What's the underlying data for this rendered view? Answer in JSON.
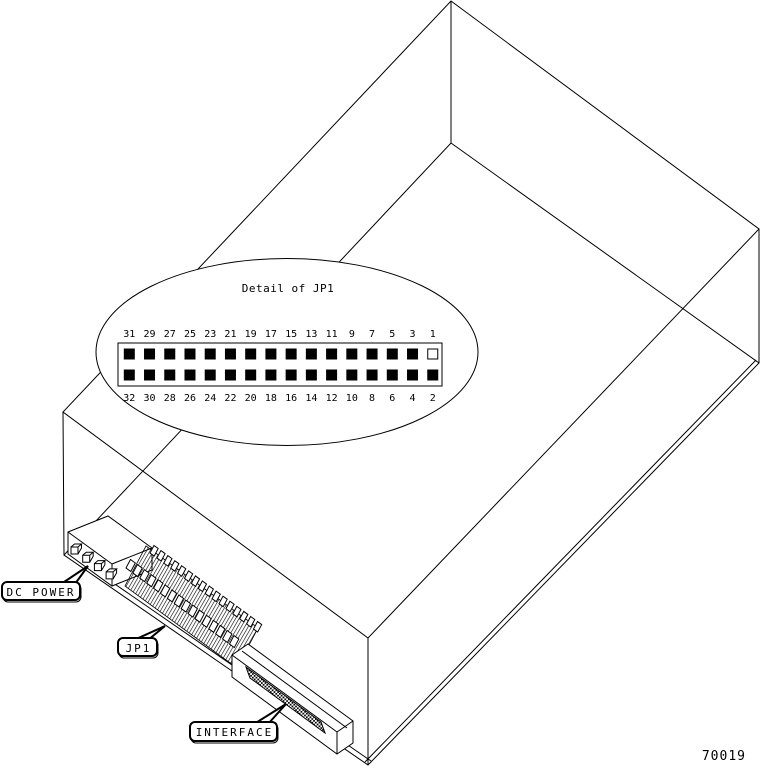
{
  "figure": {
    "id_number": "70019"
  },
  "diagram": {
    "detail_callout": {
      "title": "Detail of JP1",
      "top_pin_numbers": [
        "31",
        "29",
        "27",
        "25",
        "23",
        "21",
        "19",
        "17",
        "15",
        "13",
        "11",
        "9",
        "7",
        "5",
        "3",
        "1"
      ],
      "bottom_pin_numbers": [
        "32",
        "30",
        "28",
        "26",
        "24",
        "22",
        "20",
        "18",
        "16",
        "14",
        "12",
        "10",
        "8",
        "6",
        "4",
        "2"
      ],
      "open_pin_number": "1"
    },
    "callouts": {
      "dc_power": "DC POWER",
      "jp1": "JP1",
      "interface": "INTERFACE"
    },
    "colors": {
      "line": "#000000",
      "background": "#ffffff",
      "pin_filled": "#000000",
      "pin_open": "#ffffff"
    }
  }
}
